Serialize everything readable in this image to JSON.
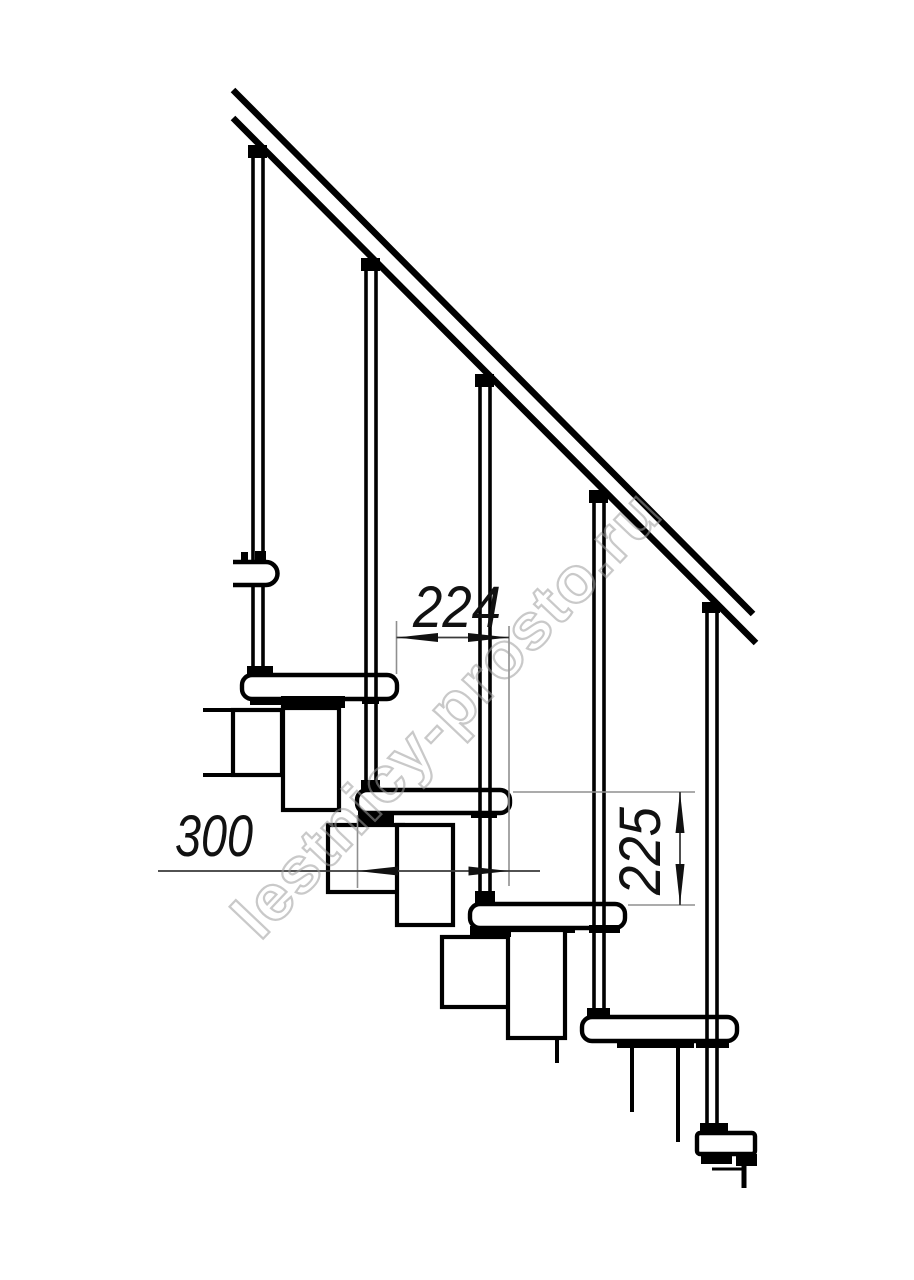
{
  "dims": {
    "d224": "224",
    "d300": "300",
    "d225": "225"
  },
  "watermark": {
    "text": "lestnicy-prosto.ru"
  },
  "colors": {
    "line": "#000000",
    "ext_line": "#8f8f8f",
    "dim_line": "#3a3a3a",
    "arrow": "#111111",
    "watermark": "#9e9e9e",
    "background": "#ffffff"
  }
}
